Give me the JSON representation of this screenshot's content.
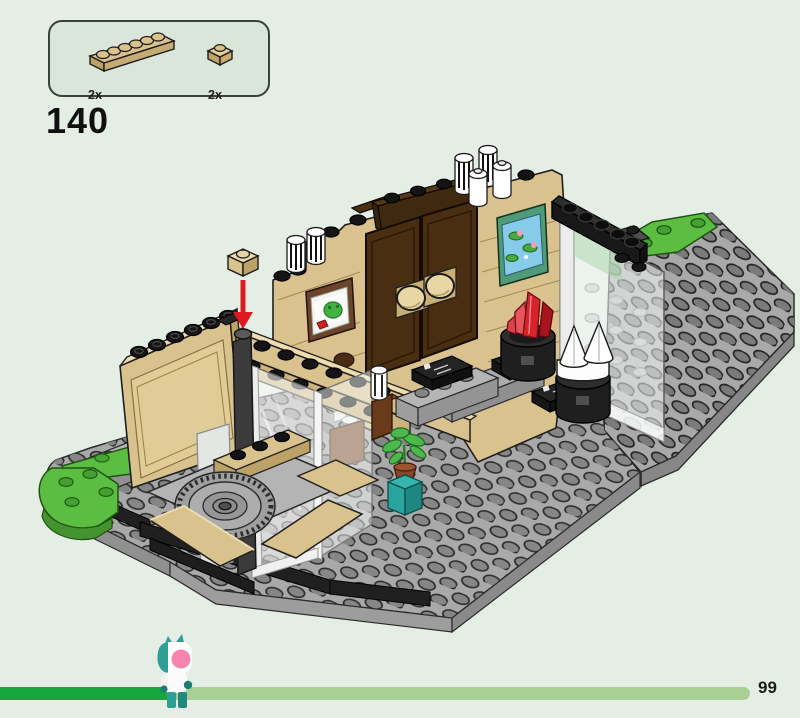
{
  "step": {
    "number": "140"
  },
  "parts_panel": {
    "items": [
      {
        "part": "plate-1x6-tan",
        "quantity": "2x"
      },
      {
        "part": "plate-1x1-tan",
        "quantity": "2x"
      }
    ]
  },
  "build_view": {
    "description": "Isometric LEGO model: tan-walled room with brown double doors, two framed paintings, glass wall panels, gray studded baseplates, green grass patches, a turntable, display pedestals holding a red crystal and white cones, a potted plant, and a red arrow showing placement of a tan 1x1 plate on the front corner."
  },
  "progress": {
    "page_number": "99",
    "percent_complete": 22
  },
  "colors": {
    "background": "#e4eee5",
    "panel_fill": "#dbe6da",
    "panel_border": "#3b403b",
    "tan": "#d9c28d",
    "tan_light": "#ecdcb0",
    "tan_dark": "#bda268",
    "door_brown": "#4a2e11",
    "plate_gray": "#a9a9a9",
    "stud_gray": "#7f7f7f",
    "black_part": "#1e1e1e",
    "grass_green": "#5cbd43",
    "glass": "#f4f7f5",
    "crystal_red": "#d7232b",
    "teal": "#2aa49e",
    "arrow_red": "#e0181f",
    "progress_fill": "#17a63e",
    "progress_track": "#a9cf97",
    "text": "#1a1a1a"
  }
}
